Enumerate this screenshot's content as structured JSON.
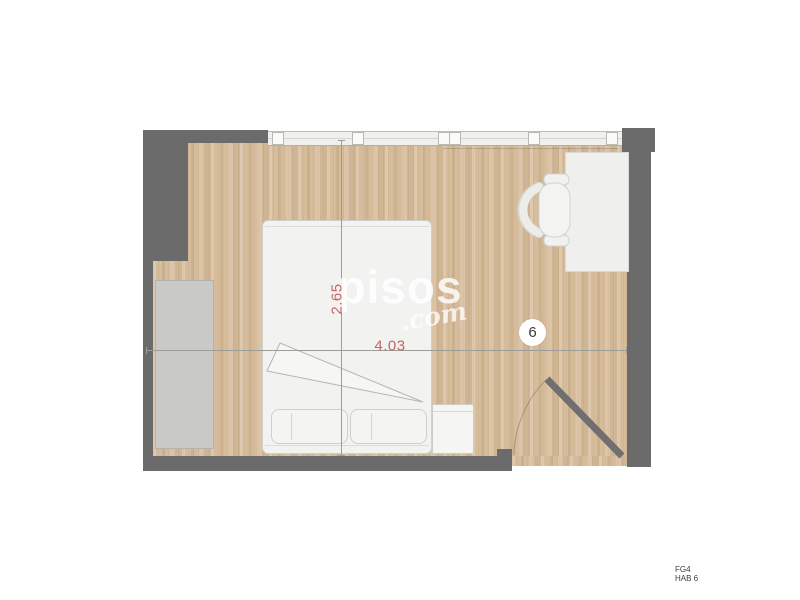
{
  "watermark": {
    "brand": "pisos",
    "tld": ".com"
  },
  "dimensions": {
    "horizontal": "4.03",
    "vertical": "2.65"
  },
  "room": {
    "badge": "6"
  },
  "footer": {
    "line1": "FG4",
    "line2": "HAB 6"
  },
  "colors": {
    "wall": "#6b6b6b",
    "floor": "#d6bc9b",
    "dimension_text": "#c5675f",
    "furniture_fill": "#f2f2f0",
    "wardrobe_fill": "#c9c9c7",
    "watermark": "#ffffff"
  }
}
